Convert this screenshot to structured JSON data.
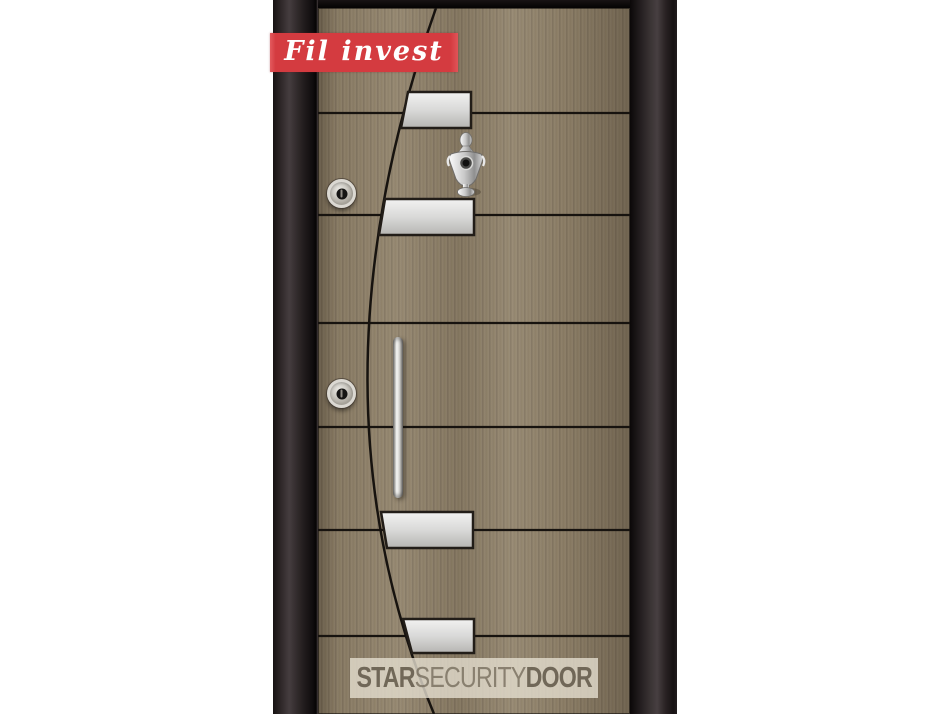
{
  "image": {
    "type": "product-photo",
    "subject": "steel security door with decorative arc, steel plates, twin lock cylinders, pull handle and knocker"
  },
  "brand_badge": {
    "label": "Fil invest",
    "background_color": "#d43b40",
    "text_color": "#ffffff"
  },
  "watermark": {
    "segments": [
      {
        "text": "STAR",
        "weight": "bold"
      },
      {
        "text": "SECURITY",
        "weight": "normal"
      },
      {
        "text": "DOOR",
        "weight": "bold"
      }
    ],
    "band_color": "rgba(228,221,206,0.8)",
    "text_color": "#5f5647"
  },
  "door": {
    "frame_color": "#241e1f",
    "wood_color": "#8d7f69",
    "groove_color": "#17130f",
    "plate_color": "#d9d9d9",
    "hardware": {
      "steel_plates": 4,
      "lock_cylinders": 2,
      "has_knocker": true,
      "has_pull_handle": true
    }
  }
}
